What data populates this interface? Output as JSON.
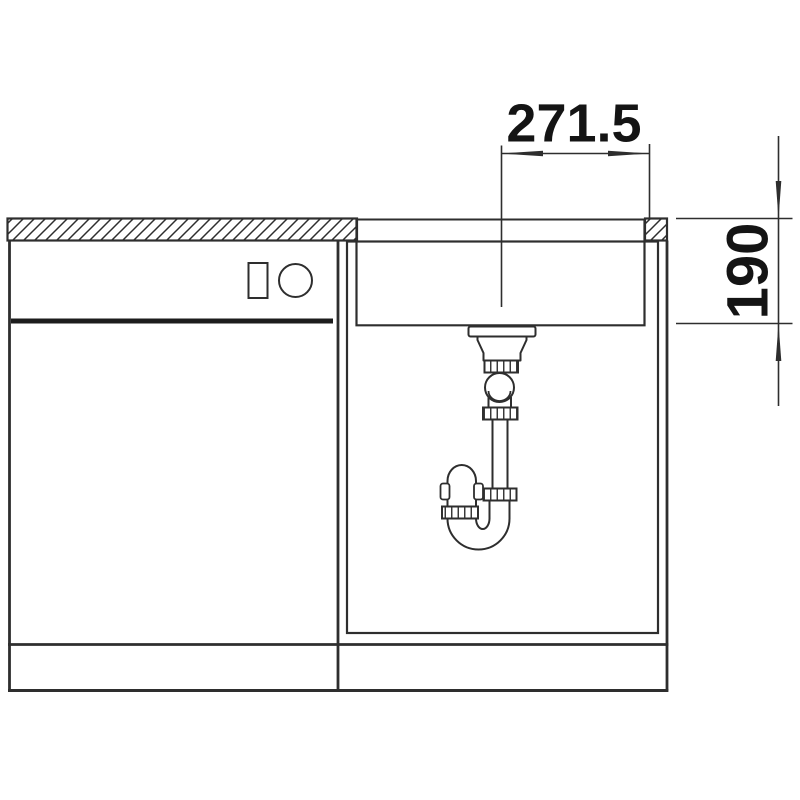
{
  "meta": {
    "title": "Undermount kitchen sink installation drawing, front section view",
    "drawing_style": "black line art on white"
  },
  "dimensions": {
    "width": {
      "label": "271.5",
      "value": 271.5,
      "meaning": "drain centre to right worktop edge"
    },
    "depth": {
      "label": "190",
      "value": 190,
      "meaning": "bowl depth from worktop top to bowl bottom"
    }
  },
  "colors": {
    "background": "#ffffff",
    "line": "#2e2e2e",
    "text": "#141414",
    "door_bar": "#1d1d1d"
  }
}
